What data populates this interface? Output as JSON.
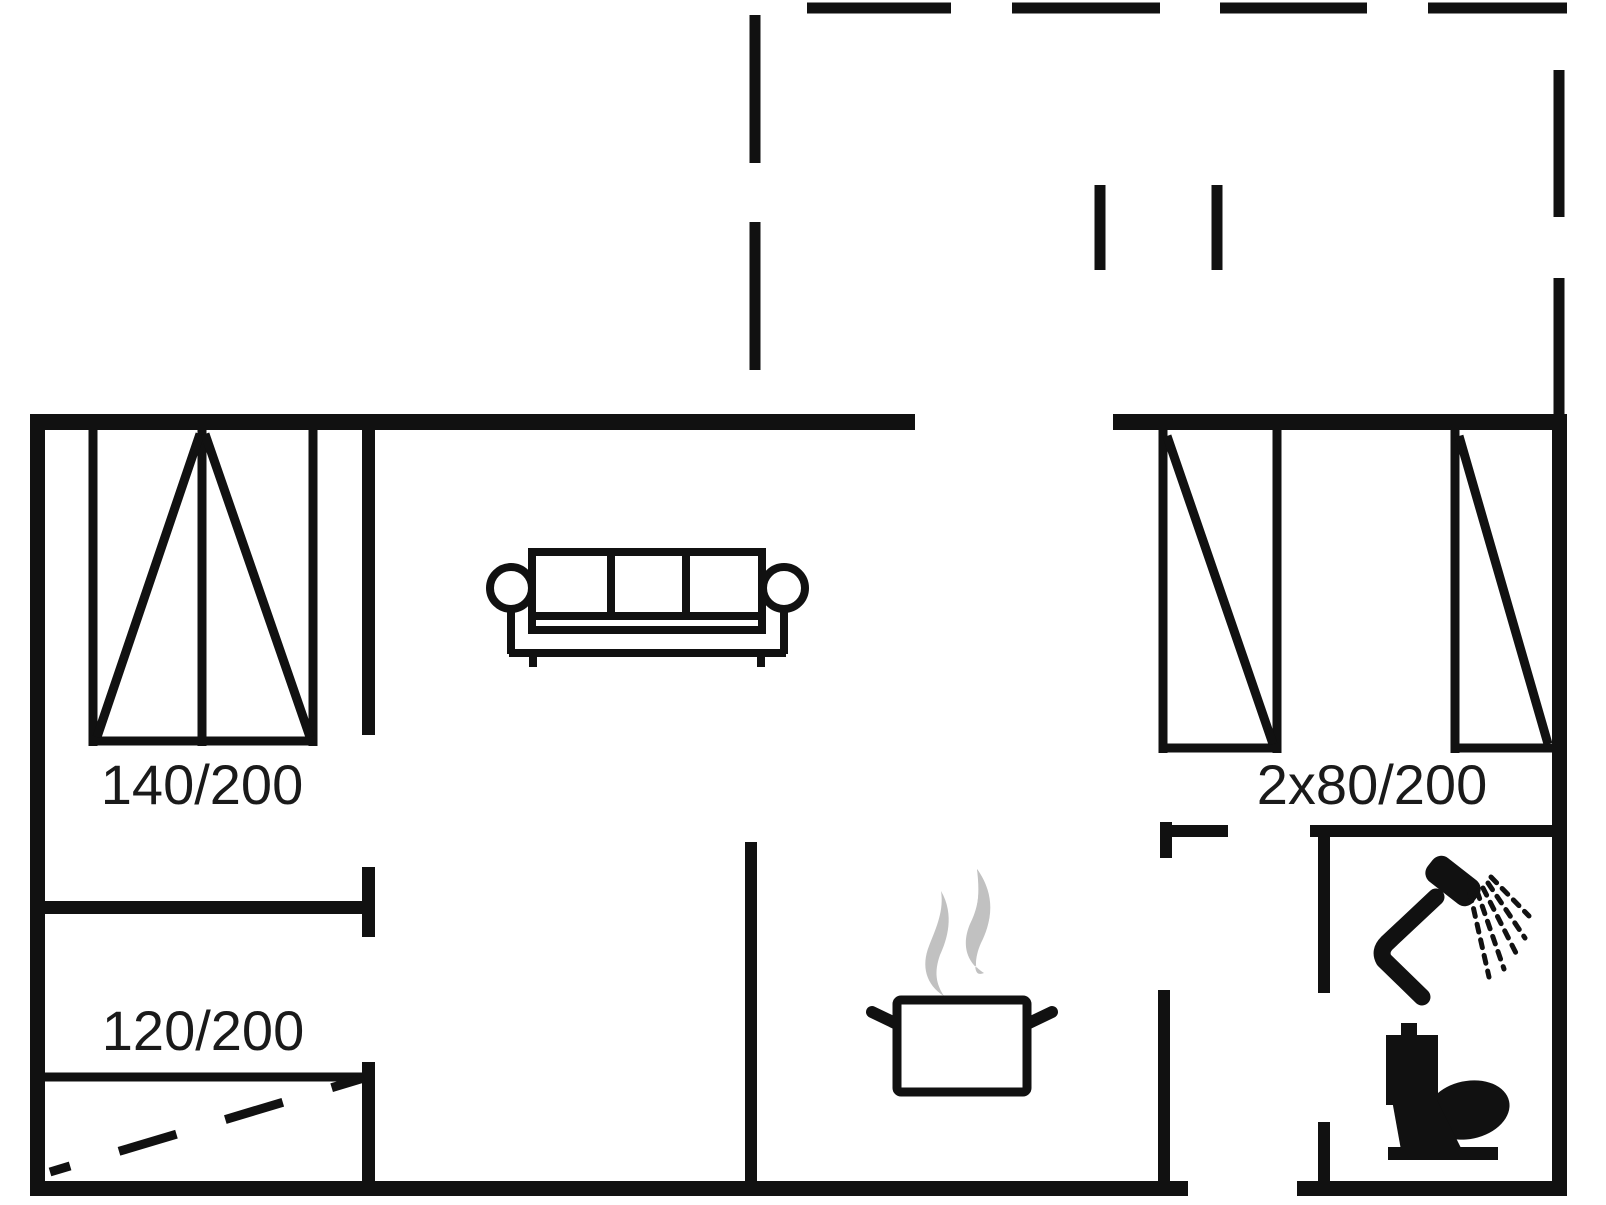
{
  "plan": {
    "type": "holiday-house-floor-plan",
    "labels": {
      "double_bed": "140/200",
      "extra_bed": "120/200",
      "twin_beds": "2x80/200"
    },
    "colors": {
      "line": "#111111",
      "background": "#ffffff",
      "steam": "#c1c1c1",
      "text": "#1a1a1a"
    },
    "icons": [
      "double-bed-icon",
      "extra-bed-icon",
      "twin-bed-left-icon",
      "twin-bed-right-icon",
      "sofa-icon",
      "cooking-pot-icon",
      "steam-icon",
      "shower-icon",
      "toilet-icon",
      "terrace-dashed-outline"
    ]
  }
}
